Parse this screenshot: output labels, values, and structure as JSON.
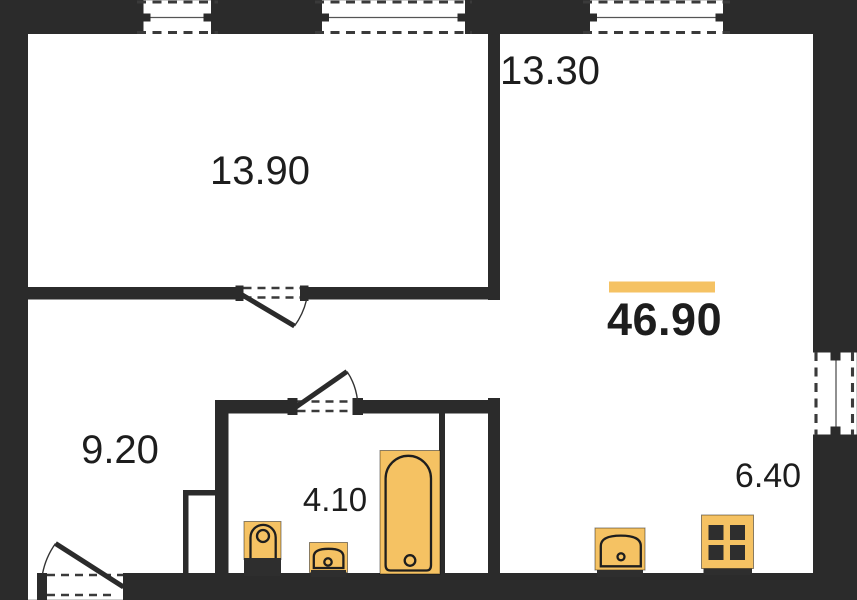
{
  "plan": {
    "title": "Apartment floor plan",
    "total_area": "46.90",
    "rooms": [
      {
        "name": "room-top-left",
        "area": "13.90"
      },
      {
        "name": "room-top-right",
        "area": "13.30"
      },
      {
        "name": "hallway",
        "area": "9.20"
      },
      {
        "name": "bathroom",
        "area": "4.10"
      },
      {
        "name": "kitchen-corner",
        "area": "6.40"
      }
    ],
    "fixtures": [
      "bathtub",
      "toilet",
      "washbasin",
      "kitchen-sink",
      "stove"
    ],
    "openings": [
      "window-top-1",
      "window-top-2",
      "window-top-3",
      "window-right",
      "door-room",
      "door-bathroom",
      "door-entrance"
    ],
    "colors": {
      "wall": "#2b2b2b",
      "accent": "#f5c263",
      "text": "#1d1d1d",
      "background": "#ffffff"
    }
  }
}
